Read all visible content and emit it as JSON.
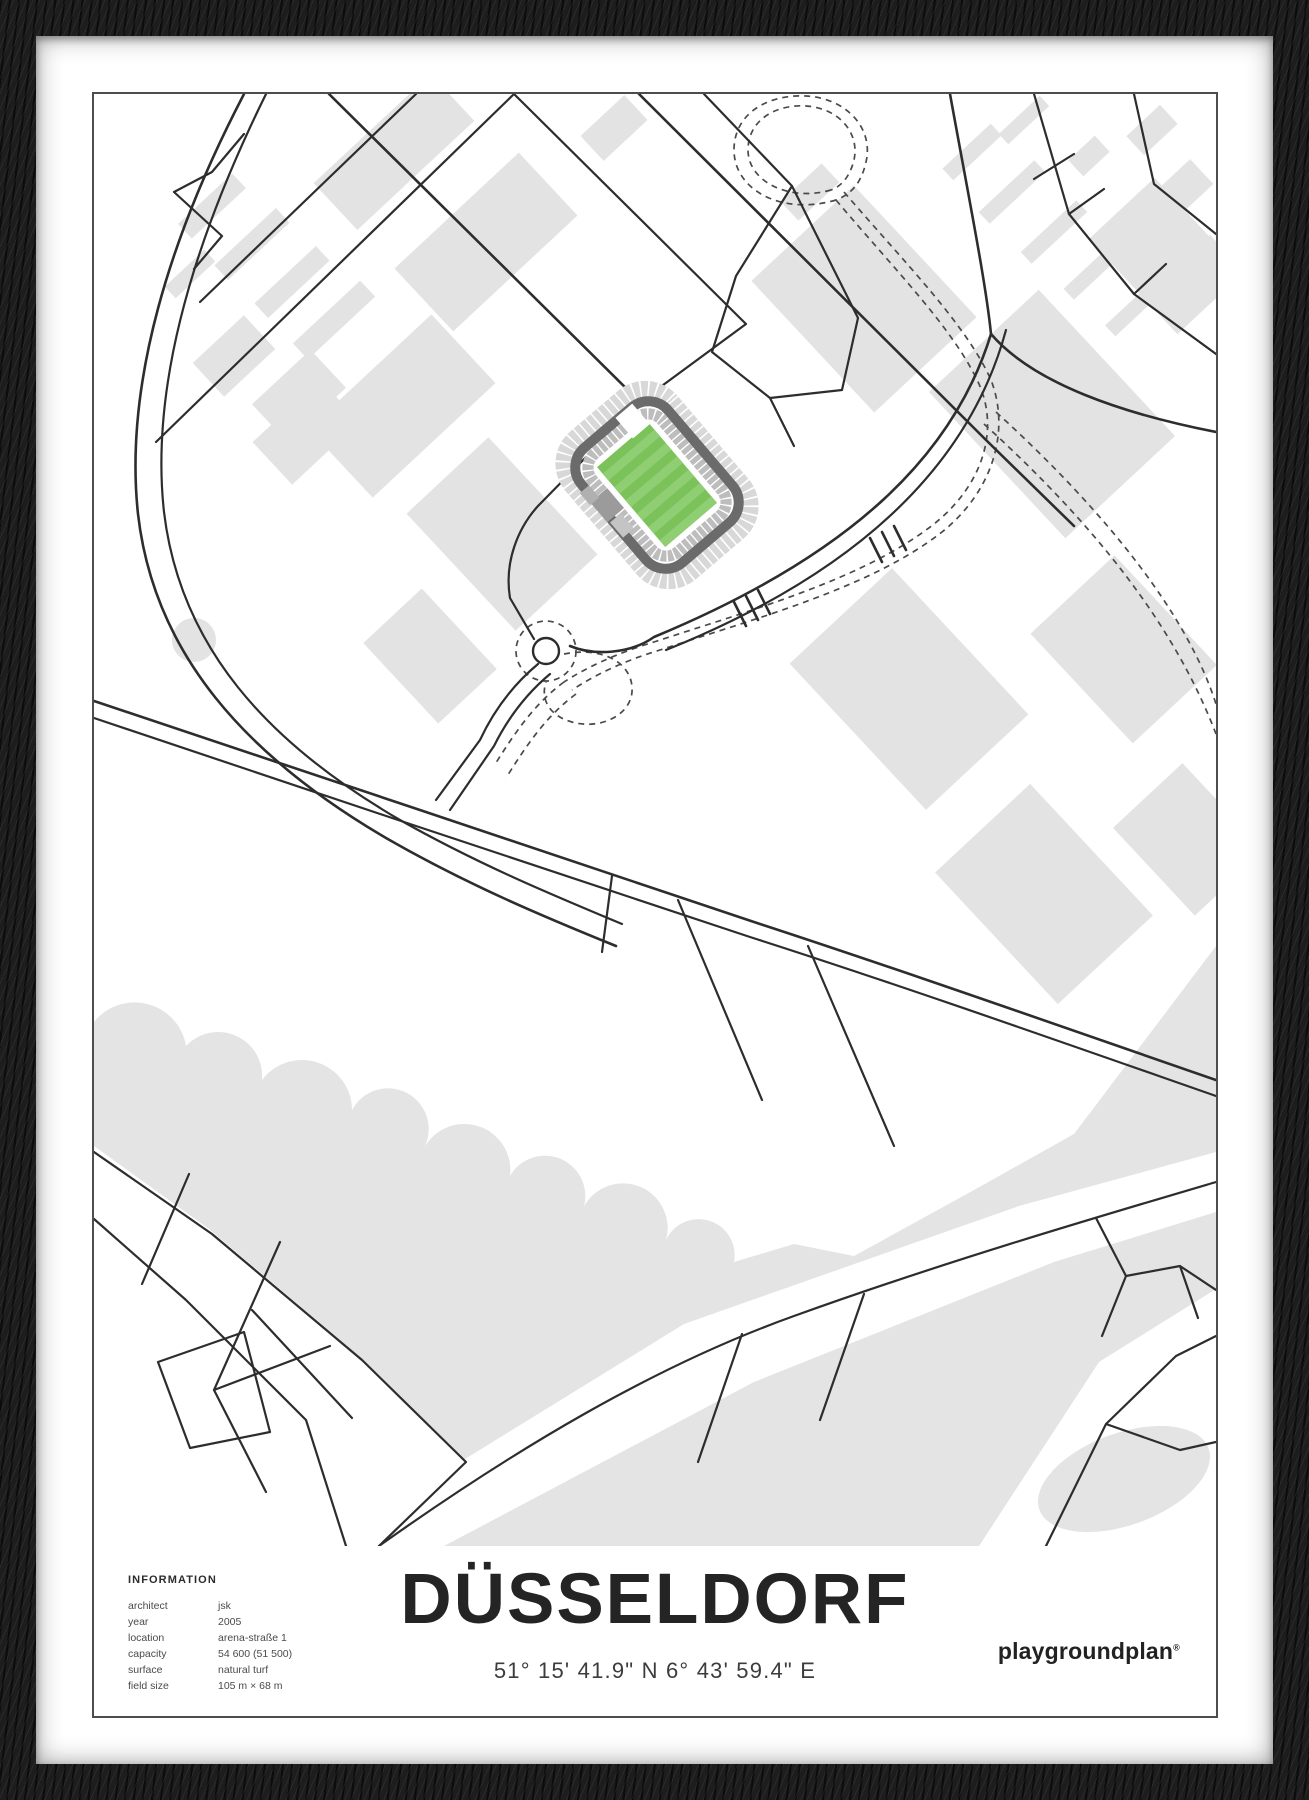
{
  "poster": {
    "title": "DÜSSELDORF",
    "coordinates": "51° 15' 41.9\" N  6° 43' 59.4\" E",
    "brand": "playgroundplan",
    "brand_mark": "®",
    "information": {
      "heading": "INFORMATION",
      "rows": [
        {
          "label": "architect",
          "value": "jsk"
        },
        {
          "label": "year",
          "value": "2005"
        },
        {
          "label": "location",
          "value": "arena-straße 1"
        },
        {
          "label": "capacity",
          "value": "54 600 (51 500)"
        },
        {
          "label": "surface",
          "value": "natural turf"
        },
        {
          "label": "field size",
          "value": "105 m × 68 m"
        }
      ]
    }
  },
  "map": {
    "colors": {
      "road": "#2d2d2d",
      "block": "#e3e3e3",
      "river": "#e4e4e4",
      "tram": "#4a4a4a",
      "stand_light": "#d8d8d8",
      "stand_mid": "#bdbdbd",
      "stand_dark": "#6b6b6b",
      "pitch_green": "#7bc25a",
      "pitch_stripe": "#90ce73"
    }
  },
  "frame": {
    "frame_color": "#161616",
    "mat_color": "#ffffff",
    "border_color": "#4d4d4d"
  }
}
